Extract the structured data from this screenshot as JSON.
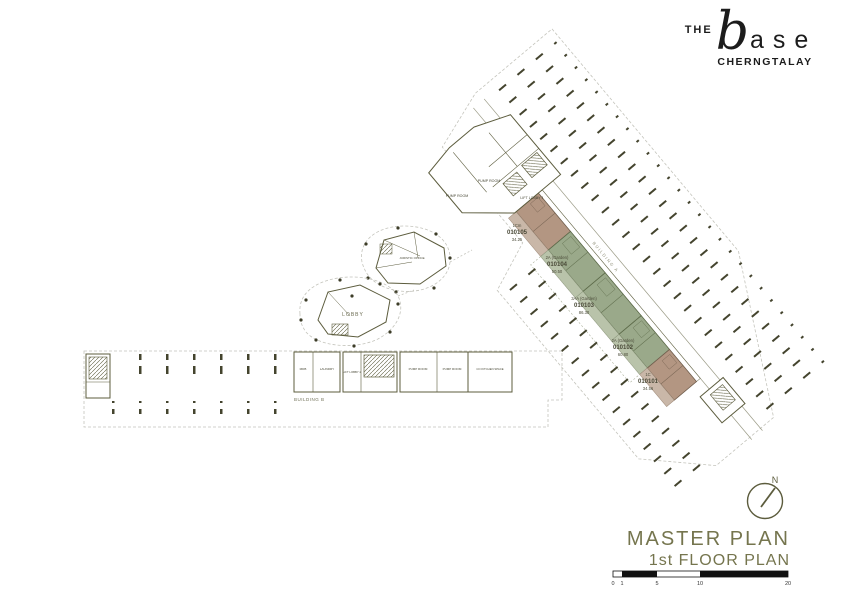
{
  "logo": {
    "the": "THE",
    "base_initial": "b",
    "base_rest": "ase",
    "location": "CHERNGTALAY"
  },
  "title_block": {
    "compass_label": "N",
    "title": "MASTER PLAN",
    "subtitle": "1st FLOOR PLAN",
    "scale_ticks": [
      "0",
      "1",
      "5",
      "10",
      "20"
    ]
  },
  "plan": {
    "building_a": {
      "label": "BUILDING A",
      "rooms": {
        "pump_room_1": "PUMP ROOM",
        "pump_room_2": "PUMP ROOM",
        "lift_lobby": "LIFT LOBBY 1"
      },
      "units": [
        {
          "type": "1Cm",
          "number": "010105",
          "area": "34.25"
        },
        {
          "type": "2A (Garden)",
          "number": "010104",
          "area": "50.50"
        },
        {
          "type": "3AA (Garden)",
          "number": "010103",
          "area": "86.30"
        },
        {
          "type": "2A (Garden)",
          "number": "010102",
          "area": "60.80"
        },
        {
          "type": "1C",
          "number": "010101",
          "area": "34.56"
        }
      ]
    },
    "building_b": {
      "label": "BUILDING B",
      "rooms": {
        "mdb": "MDB",
        "laundry": "LAUNDRY",
        "lift_lobby": "LIFT LOBBY 2",
        "pump_room_1": "PUMP ROOM",
        "pump_room_2": "PUMP ROOM",
        "co_kitchen": "CO KITCHEN SPACE"
      }
    },
    "clubhouse": {
      "lobby": "LOBBY",
      "juristic_office": "JURISTIC OFFICE"
    }
  },
  "colors": {
    "olive_line": "#5c5c3d",
    "green_unit": "#9aa98a",
    "brown_unit": "#b39682",
    "accent_text": "#75754e",
    "ink": "#1c1c1c"
  }
}
